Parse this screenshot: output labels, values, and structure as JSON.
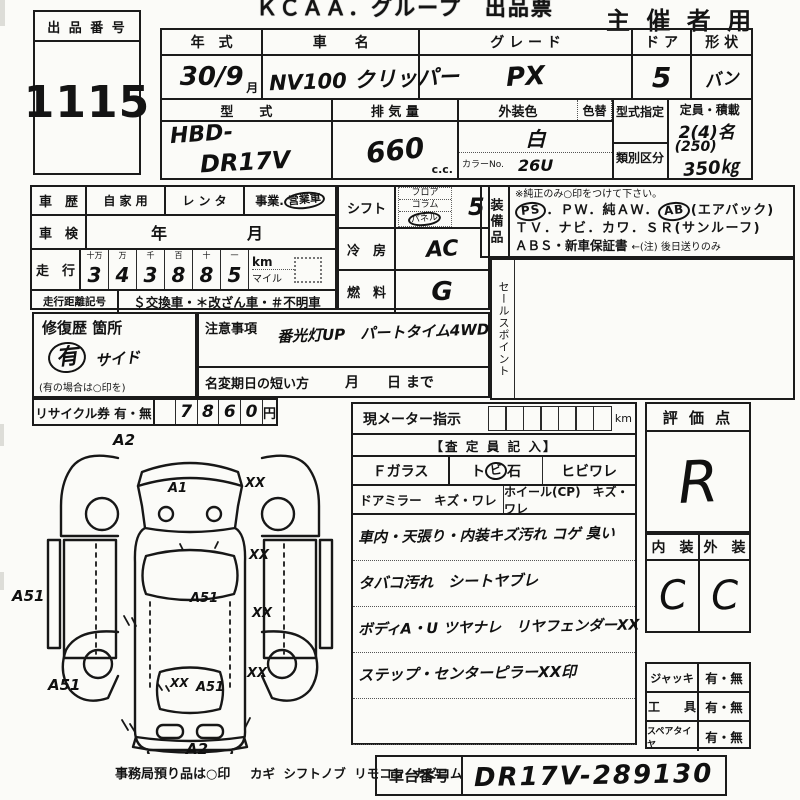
{
  "header": {
    "title": "ＫＣＡＡ．グループ　出品票",
    "audience": "主 催 者 用"
  },
  "exhibit": {
    "label": "出 品 番 号",
    "number": "1115"
  },
  "top": {
    "year_label": "年　式",
    "year": "30/9",
    "year_unit": "月",
    "name_label": "車　　名",
    "name": "NV100 クリッパー",
    "grade_label": "グ レ ー ド",
    "grade": "PX",
    "door_label": "ド ア",
    "door": "5",
    "shape_label": "形 状",
    "shape": "バン",
    "model_label": "型　　式",
    "model1": "HBD-",
    "model2": "DR17V",
    "disp_label": "排 気 量",
    "disp": "660",
    "disp_unit": "c.c.",
    "color_label": "外装色",
    "color": "白",
    "color_no_label": "カラーNo.",
    "color_no": "26U",
    "color_change_label": "色替",
    "type_desig_label": "型式指定",
    "class_label": "類別区分",
    "capacity_label": "定員・積載",
    "capacity1": "2(4)名",
    "capacity2": "(250)",
    "capacity3": "350㎏"
  },
  "history": {
    "label": "車　歴",
    "opt1": "自 家 用",
    "opt2": "レ ン タ",
    "opt3_plain": "事業.",
    "opt3_circled": "営業車"
  },
  "inspection": {
    "label": "車　検",
    "value": "年　　　月"
  },
  "mileage": {
    "label": "走　行",
    "headers": [
      "十万",
      "万",
      "千",
      "百",
      "十",
      "一"
    ],
    "digits": [
      "3",
      "4",
      "3",
      "8",
      "8",
      "5"
    ],
    "unit_km": "km",
    "unit_mile": "マイル"
  },
  "odo": {
    "label": "走行距離記号",
    "value": "＄交換車・＊改ざん車・＃不明車"
  },
  "shift": {
    "label": "シフト",
    "opt1": "フロア",
    "opt2": "コラム",
    "opt3": "パネル",
    "value": "5"
  },
  "cooling": {
    "label": "冷　房",
    "value": "AC"
  },
  "fuel": {
    "label": "燃　料",
    "value": "G"
  },
  "equipment": {
    "label": "装備品",
    "note": "※純正のみ○印をつけて下さい。",
    "l1a": "PS",
    "l1b": "．ＰＷ．純ＡＷ．",
    "l1c": "AB",
    "l1d": "(エアバック)",
    "l2": "ＴＶ．ナビ．カワ．ＳＲ(サンルーフ)",
    "l3a": "ＡＢＳ・新車保証書",
    "l3b": "←(注) 後日送りのみ"
  },
  "sales_point": {
    "label": "セールスポイント"
  },
  "repair": {
    "label": "修復歴 箇所",
    "mark": "有",
    "detail": "サイド",
    "note": "(有の場合は○印を)"
  },
  "caution": {
    "label": "注意事項",
    "value": "番光灯UP　パートタイム4WD",
    "rename_label": "名変期日の短い方",
    "rename_value": "月　　日 まで"
  },
  "recycle": {
    "label": "リサイクル券 有・無",
    "digits": [
      "7",
      "8",
      "6",
      "0"
    ],
    "unit": "円"
  },
  "meter": {
    "label": "現メーター指示",
    "unit": "km"
  },
  "assessor": {
    "header": "【査 定 員 記 入】",
    "glass": "Ｆガラス",
    "stone_pre": "ト",
    "stone_circled": "ビ",
    "stone_post": "石",
    "crack": "ヒビワレ",
    "mirror": "ドアミラー　キズ・ワレ",
    "wheel": "ホイール(CP)　キズ・ワレ",
    "notes": [
      "車内・天張り・内装キズ汚れ コゲ 臭い",
      "タバコ汚れ　シートヤブレ",
      "ボディA・U ツヤナレ　リヤフェンダーXX",
      "ステップ・センターピラーXX印"
    ]
  },
  "rating": {
    "label": "評 価 点",
    "value": "R"
  },
  "interior_exterior": {
    "interior_label": "内　装",
    "exterior_label": "外　装",
    "interior": "C",
    "exterior": "C"
  },
  "accessories": {
    "rows": [
      {
        "label": "ジャッキ",
        "value": "有・無"
      },
      {
        "label": "工　　具",
        "value": "有・無"
      },
      {
        "label": "スペアタイヤ",
        "value": "有・無"
      }
    ]
  },
  "footer": {
    "office": "事務局預り品は○印",
    "items": "カギ シフトノブ リモコン ナビロム"
  },
  "chassis": {
    "label": "車台番号",
    "value": "DR17V-289130"
  },
  "diagram": {
    "labels": [
      "A2",
      "A1",
      "XX",
      "XX",
      "A51",
      "A51",
      "XX",
      "A51",
      "XX",
      "A51",
      "XX",
      "A2"
    ]
  }
}
